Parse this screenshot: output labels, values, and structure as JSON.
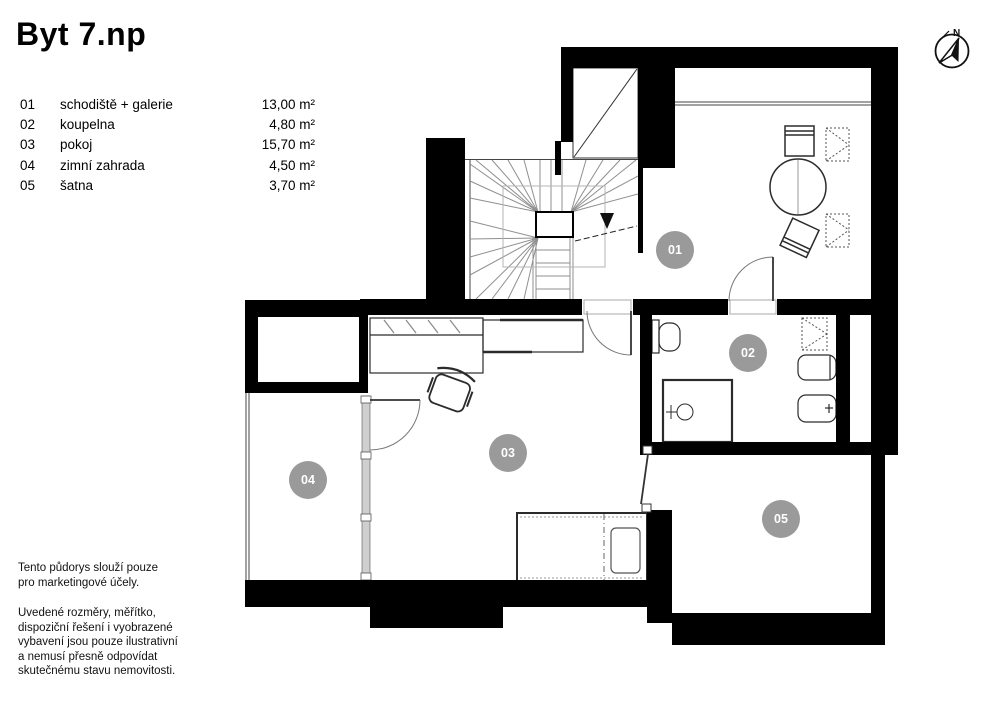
{
  "title": "Byt 7.np",
  "legend": {
    "rows": [
      {
        "num": "01",
        "name": "schodiště + galerie",
        "area": "13,00 m²"
      },
      {
        "num": "02",
        "name": "koupelna",
        "area": "4,80 m²"
      },
      {
        "num": "03",
        "name": "pokoj",
        "area": "15,70 m²"
      },
      {
        "num": "04",
        "name": "zimní zahrada",
        "area": "4,50 m²"
      },
      {
        "num": "05",
        "name": "šatna",
        "area": "3,70 m²"
      }
    ]
  },
  "badges": {
    "b1": "01",
    "b2": "02",
    "b3": "03",
    "b4": "04",
    "b5": "05"
  },
  "compass": {
    "north_label": "N"
  },
  "disclaimer": {
    "para1_line1": "Tento půdorys slouží pouze",
    "para1_line2": "pro marketingové účely.",
    "para2_line1": "Uvedené rozměry, měřítko,",
    "para2_line2": "dispoziční řešení i vyobrazené",
    "para2_line3": "vybavení jsou pouze ilustrativní",
    "para2_line4": "a nemusí přesně odpovídat",
    "para2_line5": "skutečnému stavu nemovitosti."
  },
  "colors": {
    "wall": "#000000",
    "badge": "#9a9a9a",
    "stair_line": "#8f8f8f",
    "furniture_line": "#2b2b2b",
    "glazing": "#cfcfcf"
  }
}
